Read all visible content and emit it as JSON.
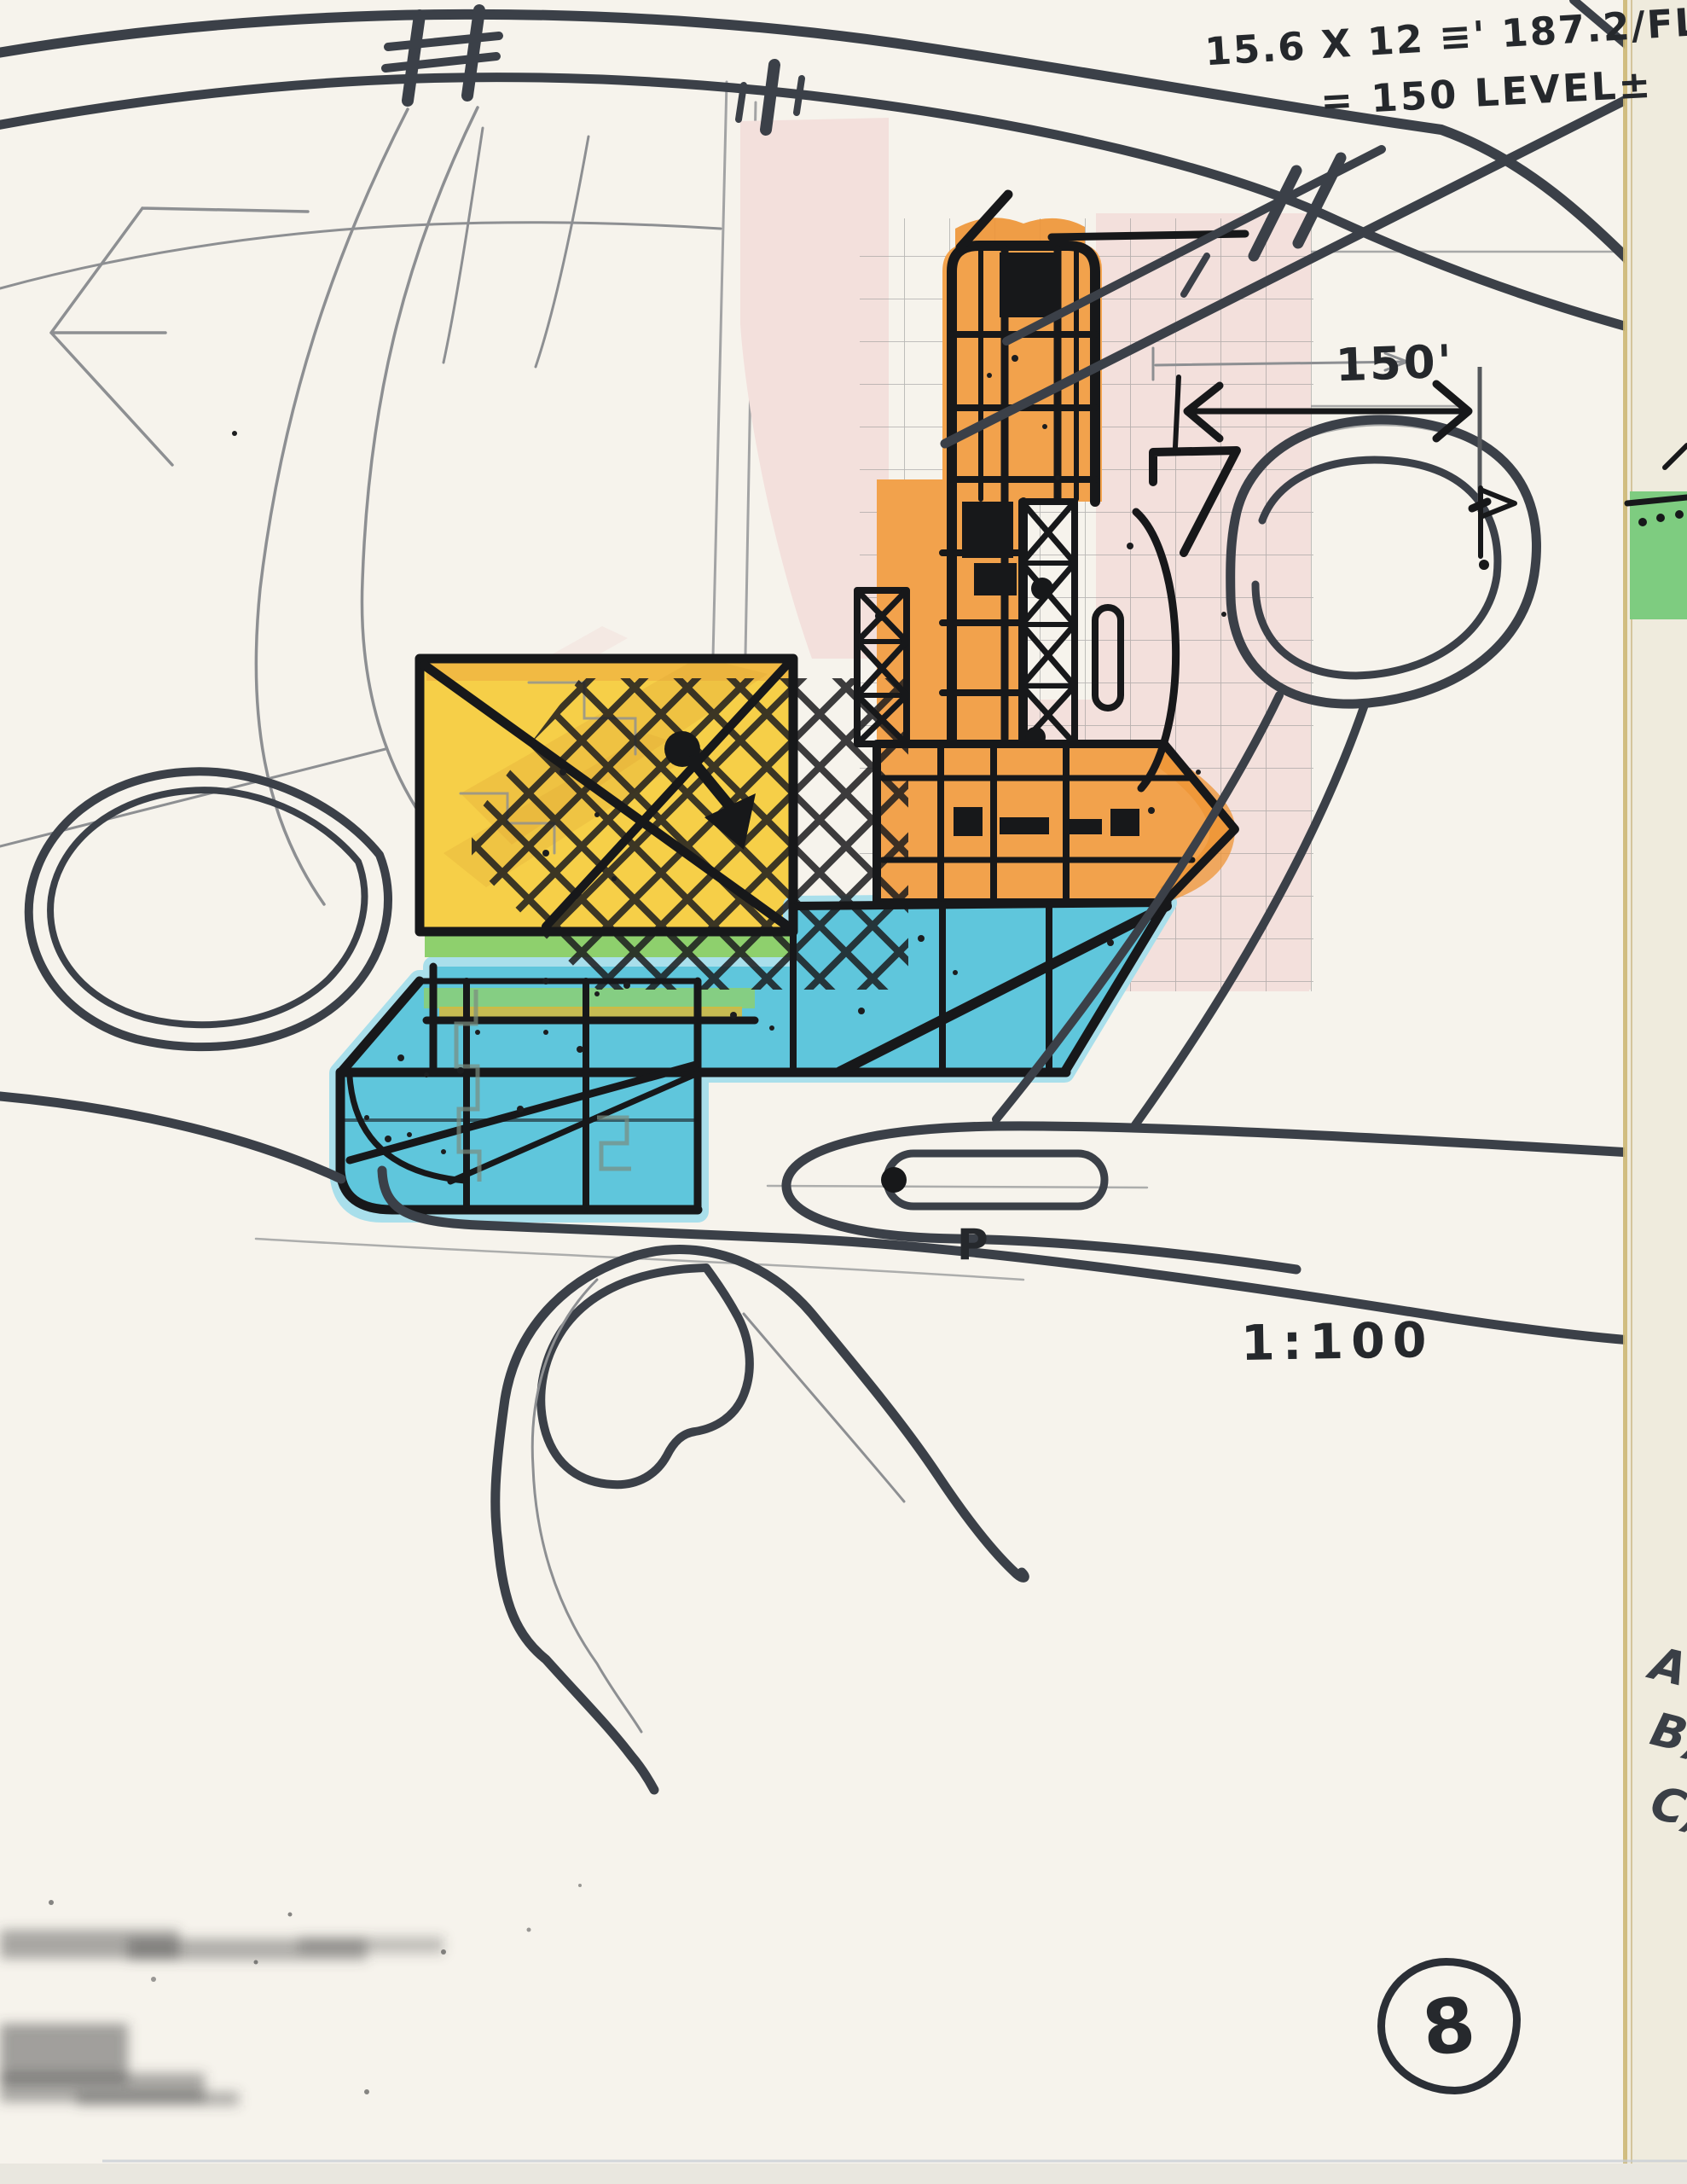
{
  "colors": {
    "paper": "#f6f3ec",
    "paper_strip": "#efebdd",
    "ink": "#17181a",
    "marker_road": "#3b4048",
    "pencil": "#8d8f92",
    "orange": "#f2a24c",
    "orange_deep": "#ee9434",
    "yellow": "#f6cf48",
    "ochre": "#dda435",
    "blue": "#5fc6dc",
    "blue_halo": "#a9dfeb",
    "green_strip": "#8ed06d",
    "green_patch": "#7ecc80",
    "pink": "#f3e0dc",
    "binding": "#cdb876"
  },
  "annotations": {
    "calc_line1": "15.6 X 12 ≡' 187.2/FL-37",
    "calc_line2": "= 150 LEVEL±",
    "dimension_150ft": "150'",
    "scale_note": "1:100",
    "parking_label": "P",
    "page_number": "8",
    "margin_letters": [
      "A",
      "B)",
      "C)"
    ]
  }
}
